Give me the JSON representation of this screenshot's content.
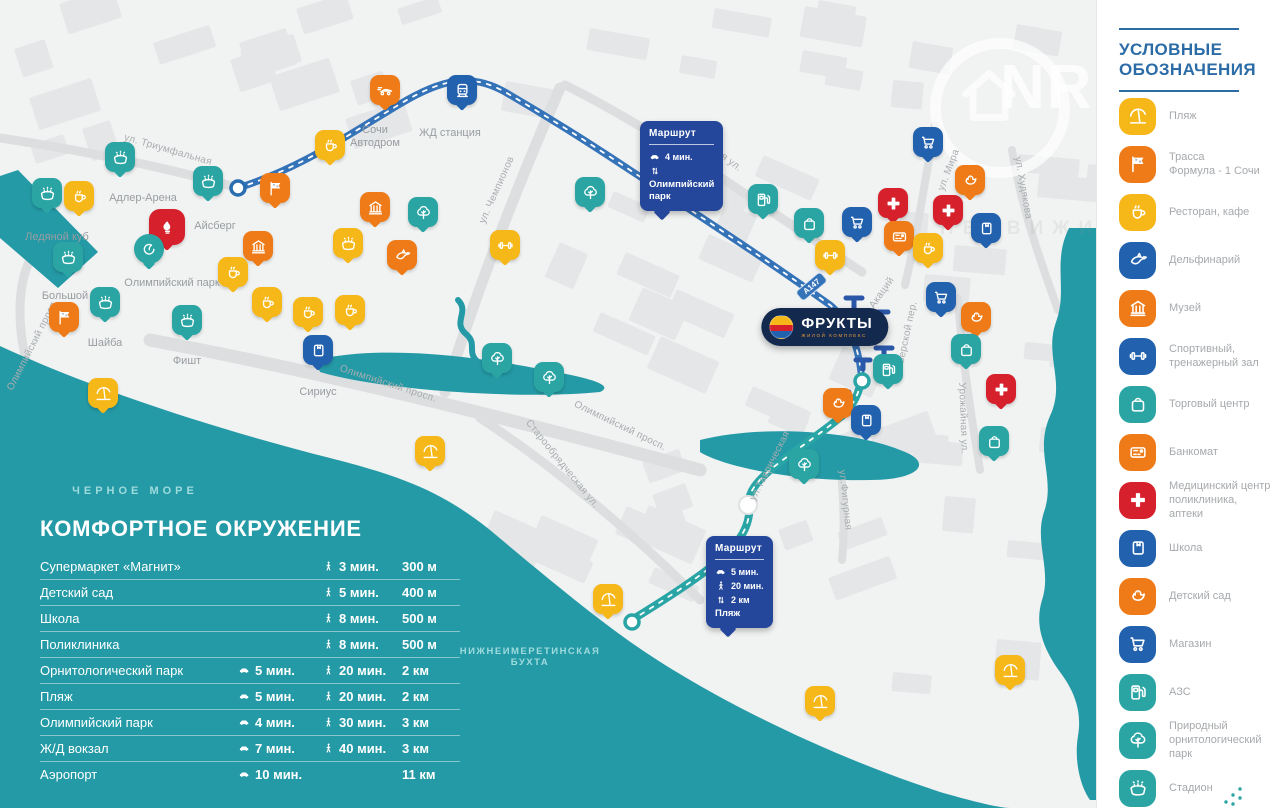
{
  "colors": {
    "yellow": "#f6b719",
    "orange": "#ee7b17",
    "blue": "#2261ae",
    "teal": "#2aa5a4",
    "red": "#d6202c",
    "navy": "#24479b",
    "sea": "#249aa6",
    "badge_navy": "#13294e"
  },
  "logo": {
    "name": "ФРУКТЫ",
    "sub": "ЖИЛОЙ КОМПЛЕКС"
  },
  "watermark": {
    "letters": "NR",
    "tagline": "НЕДВИЖИМОСТЬ"
  },
  "legend": {
    "title1": "УСЛОВНЫЕ",
    "title2": "ОБОЗНАЧЕНИЯ",
    "items": [
      {
        "icon": "beach",
        "color": "yellow",
        "label": "Пляж"
      },
      {
        "icon": "formula",
        "color": "orange",
        "label": "Трасса\nФормула - 1 Сочи"
      },
      {
        "icon": "cafe",
        "color": "yellow",
        "label": "Ресторан, кафе"
      },
      {
        "icon": "dolphin",
        "color": "blue",
        "label": "Дельфинарий"
      },
      {
        "icon": "museum",
        "color": "orange",
        "label": "Музей"
      },
      {
        "icon": "gym",
        "color": "blue",
        "label": "Спортивный,\nтренажерный зал"
      },
      {
        "icon": "mall",
        "color": "teal",
        "label": "Торговый центр"
      },
      {
        "icon": "atm",
        "color": "orange",
        "label": "Банкомат"
      },
      {
        "icon": "medical",
        "color": "red",
        "label": "Медицинский центр\nполиклиника,\nаптеки"
      },
      {
        "icon": "school",
        "color": "blue",
        "label": "Школа"
      },
      {
        "icon": "kindergarten",
        "color": "orange",
        "label": "Детский сад"
      },
      {
        "icon": "shop",
        "color": "blue",
        "label": "Магазин"
      },
      {
        "icon": "gas",
        "color": "teal",
        "label": "АЗС"
      },
      {
        "icon": "tree",
        "color": "teal",
        "label": "Природный\nорнитологический\nпарк"
      },
      {
        "icon": "stadium",
        "color": "teal",
        "label": "Стадион"
      }
    ]
  },
  "table": {
    "title": "КОМФОРТНОЕ ОКРУЖЕНИЕ",
    "rows": [
      {
        "name": "Супермаркет «Магнит»",
        "car": "",
        "walk": "3 мин.",
        "dist": "300 м"
      },
      {
        "name": "Детский сад",
        "car": "",
        "walk": "5 мин.",
        "dist": "400 м"
      },
      {
        "name": "Школа",
        "car": "",
        "walk": "8 мин.",
        "dist": "500 м"
      },
      {
        "name": "Поликлиника",
        "car": "",
        "walk": "8 мин.",
        "dist": "500 м"
      },
      {
        "name": "Орнитологический парк",
        "car": "5 мин.",
        "walk": "20 мин.",
        "dist": "2 км"
      },
      {
        "name": "Пляж",
        "car": "5 мин.",
        "walk": "20 мин.",
        "dist": "2 км"
      },
      {
        "name": "Олимпийский парк",
        "car": "4 мин.",
        "walk": "30 мин.",
        "dist": "3 км"
      },
      {
        "name": "Ж/Д вокзал",
        "car": "7 мин.",
        "walk": "40 мин.",
        "dist": "3 км"
      },
      {
        "name": "Аэропорт",
        "car": "10 мин.",
        "walk": "",
        "dist": "11 км"
      }
    ]
  },
  "map": {
    "road_badge": "А147",
    "sea_labels": [
      {
        "text": "ЧЕРНОЕ МОРЕ",
        "x": 135,
        "y": 491,
        "size": 11,
        "ls": 4
      },
      {
        "text": "НИЖНЕИМЕРЕТИНСКАЯ\nБУХТА",
        "x": 530,
        "y": 657,
        "size": 9.5,
        "ls": 1.5
      }
    ],
    "street_labels": [
      {
        "text": "ул. Триумфальная",
        "x": 168,
        "y": 150,
        "rot": 16
      },
      {
        "text": "Урожайная ул.",
        "x": 712,
        "y": 148,
        "rot": 37
      },
      {
        "text": "ул. Чемпионов",
        "x": 497,
        "y": 190,
        "rot": -66
      },
      {
        "text": "Олимпийский просп.",
        "x": 33,
        "y": 345,
        "rot": -63
      },
      {
        "text": "Олимпийский просп.",
        "x": 388,
        "y": 384,
        "rot": 18
      },
      {
        "text": "Олимпийский просп.",
        "x": 620,
        "y": 426,
        "rot": 26
      },
      {
        "text": "Старообрядческая ул.",
        "x": 562,
        "y": 464,
        "rot": 51
      },
      {
        "text": "ул.Таврическая",
        "x": 770,
        "y": 466,
        "rot": -63
      },
      {
        "text": "ул.Фигурная",
        "x": 845,
        "y": 500,
        "rot": 84
      },
      {
        "text": "ул. Мира",
        "x": 949,
        "y": 170,
        "rot": -69
      },
      {
        "text": "ул. Худякова",
        "x": 1023,
        "y": 188,
        "rot": 80
      },
      {
        "text": "Урожайная ул.",
        "x": 963,
        "y": 418,
        "rot": 88
      },
      {
        "text": "ул. Акаций",
        "x": 877,
        "y": 300,
        "rot": -55
      },
      {
        "text": "Тверской пер.",
        "x": 907,
        "y": 335,
        "rot": -78
      }
    ],
    "place_labels": [
      {
        "text": "Адлер-Арена",
        "x": 143,
        "y": 192
      },
      {
        "text": "Айсберг",
        "x": 215,
        "y": 220
      },
      {
        "text": "Ледяной куб",
        "x": 57,
        "y": 231
      },
      {
        "text": "Большой",
        "x": 65,
        "y": 290
      },
      {
        "text": "Шайба",
        "x": 105,
        "y": 337
      },
      {
        "text": "Фишт",
        "x": 187,
        "y": 355
      },
      {
        "text": "Олимпийский парк",
        "x": 172,
        "y": 277
      },
      {
        "text": "Сириус",
        "x": 318,
        "y": 386
      },
      {
        "text": "Сочи\nАвтодром",
        "x": 375,
        "y": 124
      },
      {
        "text": "ЖД станция",
        "x": 450,
        "y": 127
      }
    ],
    "markers": [
      {
        "t": "stadium",
        "c": "teal",
        "x": 120,
        "y": 172
      },
      {
        "t": "stadium",
        "c": "teal",
        "x": 208,
        "y": 196
      },
      {
        "t": "stadium",
        "c": "teal",
        "x": 47,
        "y": 208
      },
      {
        "t": "stadium",
        "c": "teal",
        "x": 68,
        "y": 272
      },
      {
        "t": "stadium",
        "c": "teal",
        "x": 105,
        "y": 317
      },
      {
        "t": "stadium",
        "c": "teal",
        "x": 187,
        "y": 335
      },
      {
        "t": "cafe",
        "c": "yellow",
        "x": 79,
        "y": 211
      },
      {
        "t": "torch",
        "c": "red",
        "x": 167,
        "y": 245
      },
      {
        "t": "olympic",
        "c": "teal",
        "x": 149,
        "y": 264
      },
      {
        "t": "formula",
        "c": "orange",
        "x": 64,
        "y": 332
      },
      {
        "t": "formula",
        "c": "orange",
        "x": 275,
        "y": 203
      },
      {
        "t": "museum",
        "c": "orange",
        "x": 258,
        "y": 261
      },
      {
        "t": "museum",
        "c": "orange",
        "x": 375,
        "y": 222
      },
      {
        "t": "cafe",
        "c": "yellow",
        "x": 233,
        "y": 287
      },
      {
        "t": "cafe",
        "c": "yellow",
        "x": 267,
        "y": 317
      },
      {
        "t": "cafe",
        "c": "yellow",
        "x": 308,
        "y": 327
      },
      {
        "t": "cafe",
        "c": "yellow",
        "x": 350,
        "y": 325
      },
      {
        "t": "stadium",
        "c": "yellow",
        "x": 348,
        "y": 258
      },
      {
        "t": "dolphin",
        "c": "orange",
        "x": 402,
        "y": 270
      },
      {
        "t": "tree",
        "c": "teal",
        "x": 423,
        "y": 227
      },
      {
        "t": "gym",
        "c": "yellow",
        "x": 505,
        "y": 260
      },
      {
        "t": "tree",
        "c": "teal",
        "x": 590,
        "y": 207
      },
      {
        "t": "cafe",
        "c": "yellow",
        "x": 330,
        "y": 160
      },
      {
        "t": "racecar",
        "c": "orange",
        "x": 385,
        "y": 105
      },
      {
        "t": "train",
        "c": "blue",
        "x": 462,
        "y": 105
      },
      {
        "t": "school",
        "c": "blue",
        "x": 318,
        "y": 365
      },
      {
        "t": "tree",
        "c": "teal",
        "x": 497,
        "y": 373
      },
      {
        "t": "tree",
        "c": "teal",
        "x": 549,
        "y": 392
      },
      {
        "t": "beach",
        "c": "yellow",
        "x": 103,
        "y": 408
      },
      {
        "t": "beach",
        "c": "yellow",
        "x": 430,
        "y": 466
      },
      {
        "t": "beach",
        "c": "yellow",
        "x": 608,
        "y": 614
      },
      {
        "t": "beach",
        "c": "yellow",
        "x": 820,
        "y": 716
      },
      {
        "t": "beach",
        "c": "yellow",
        "x": 1010,
        "y": 685
      },
      {
        "t": "gas",
        "c": "teal",
        "x": 763,
        "y": 214
      },
      {
        "t": "mall",
        "c": "teal",
        "x": 809,
        "y": 238
      },
      {
        "t": "shop",
        "c": "blue",
        "x": 857,
        "y": 237
      },
      {
        "t": "medical",
        "c": "red",
        "x": 893,
        "y": 218
      },
      {
        "t": "medical",
        "c": "red",
        "x": 948,
        "y": 225
      },
      {
        "t": "atm",
        "c": "orange",
        "x": 899,
        "y": 251
      },
      {
        "t": "gym",
        "c": "yellow",
        "x": 830,
        "y": 270
      },
      {
        "t": "cafe",
        "c": "yellow",
        "x": 928,
        "y": 263
      },
      {
        "t": "shop",
        "c": "blue",
        "x": 928,
        "y": 157
      },
      {
        "t": "kindergarten",
        "c": "orange",
        "x": 970,
        "y": 195
      },
      {
        "t": "school",
        "c": "blue",
        "x": 986,
        "y": 243
      },
      {
        "t": "shop",
        "c": "blue",
        "x": 941,
        "y": 312
      },
      {
        "t": "kindergarten",
        "c": "orange",
        "x": 976,
        "y": 332
      },
      {
        "t": "mall",
        "c": "teal",
        "x": 966,
        "y": 364
      },
      {
        "t": "medical",
        "c": "red",
        "x": 1001,
        "y": 404
      },
      {
        "t": "mall",
        "c": "teal",
        "x": 994,
        "y": 456
      },
      {
        "t": "gas",
        "c": "teal",
        "x": 888,
        "y": 384
      },
      {
        "t": "kindergarten",
        "c": "orange",
        "x": 838,
        "y": 418
      },
      {
        "t": "school",
        "c": "blue",
        "x": 866,
        "y": 435
      },
      {
        "t": "tree",
        "c": "teal",
        "x": 804,
        "y": 479
      }
    ],
    "route_badges": [
      {
        "x": 640,
        "y": 121,
        "title": "Маршрут",
        "rows": [
          [
            "car",
            "4 мин."
          ],
          [
            "updown",
            ""
          ]
        ],
        "dest": "Олимпийский\nпарк"
      },
      {
        "x": 706,
        "y": 536,
        "title": "Маршрут",
        "rows": [
          [
            "car",
            "5 мин."
          ],
          [
            "walk",
            "20 мин."
          ],
          [
            "updown",
            "2 км"
          ]
        ],
        "dest": "Пляж"
      }
    ]
  }
}
